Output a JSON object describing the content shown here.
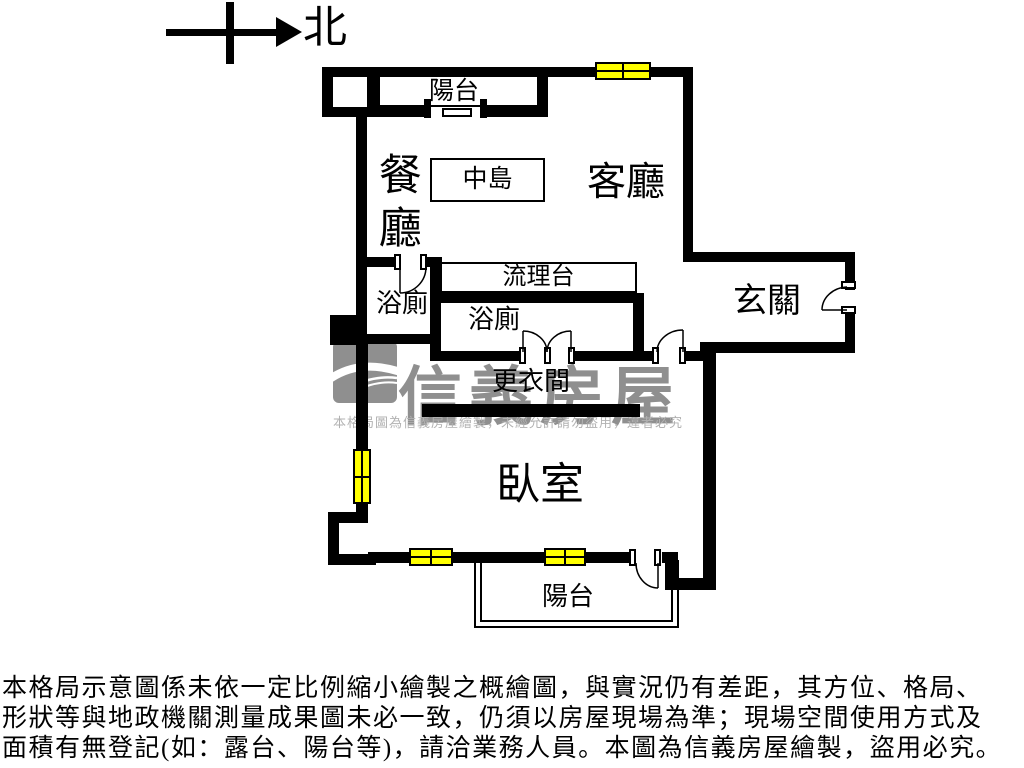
{
  "north": {
    "label": "北"
  },
  "rooms": {
    "balcony_top": "陽台",
    "dining": "餐廳",
    "island": "中島",
    "living": "客廳",
    "counter": "流理台",
    "bath1": "浴廁",
    "bath2": "浴廁",
    "entry": "玄關",
    "dressing": "更衣間",
    "bedroom": "臥室",
    "balcony_bottom": "陽台"
  },
  "watermark": {
    "brand": "信義房屋",
    "notice": "本格局圖為信義房屋繪製，未經允許請勿盜用，違者必究"
  },
  "disclaimer": {
    "line1": "本格局示意圖係未依一定比例縮小繪製之概繪圖，與實況仍有差距，其方位、格局、",
    "line2": "形狀等與地政機關測量成果圖未必一致，仍須以房屋現場為準；現場空間使用方式及",
    "line3": "面積有無登記(如：露台、陽台等)，請洽業務人員。本圖為信義房屋繪製，盜用必究。"
  },
  "colors": {
    "wall": "#000000",
    "window_fill": "#ffff00",
    "watermark_logo": "#8f8f8f",
    "watermark_text": "#b2b2b2"
  }
}
